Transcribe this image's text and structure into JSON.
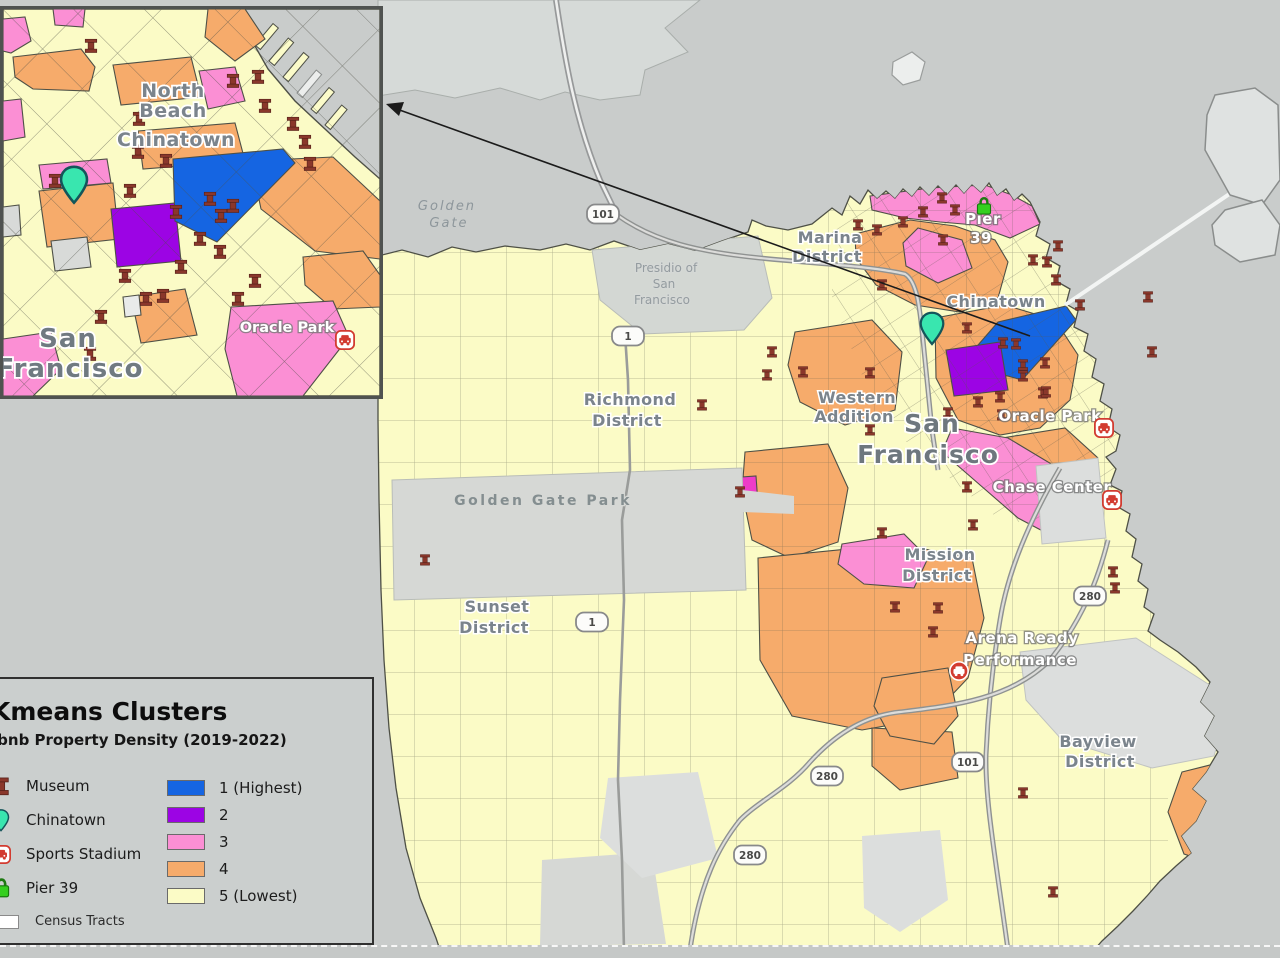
{
  "legend": {
    "title": "Kmeans Clusters",
    "subtitle": "Airbnb Property Density (2019-2022)",
    "markers": [
      {
        "label": "Museum",
        "icon": "museum-icon"
      },
      {
        "label": "Chinatown",
        "icon": "chinatown-pin-icon"
      },
      {
        "label": "Sports Stadium",
        "icon": "stadium-icon"
      },
      {
        "label": "Pier 39",
        "icon": "pier39-lock-icon"
      }
    ],
    "clusters": [
      {
        "label": "1 (Highest)",
        "color": "#1565e2"
      },
      {
        "label": "2",
        "color": "#9c04e4"
      },
      {
        "label": "3",
        "color": "#fb8fd4"
      },
      {
        "label": "4",
        "color": "#f6ab6b"
      },
      {
        "label": "5 (Lowest)",
        "color": "#fbfbc6"
      }
    ],
    "census_tracts_label": "Census Tracts"
  },
  "map": {
    "labels": [
      {
        "text": "Golden",
        "x": 447,
        "y": 210,
        "cls": "water-label"
      },
      {
        "text": "Gate",
        "x": 449,
        "y": 227,
        "cls": "water-label"
      },
      {
        "text": "Presidio of",
        "x": 666,
        "y": 272,
        "cls": "small-label"
      },
      {
        "text": "San",
        "x": 664,
        "y": 288,
        "cls": "small-label"
      },
      {
        "text": "Francisco",
        "x": 662,
        "y": 304,
        "cls": "small-label"
      },
      {
        "text": "Marina",
        "x": 830,
        "y": 243,
        "cls": "district-label"
      },
      {
        "text": "District",
        "x": 827,
        "y": 262,
        "cls": "district-label"
      },
      {
        "text": "Richmond",
        "x": 630,
        "y": 405,
        "cls": "district-label"
      },
      {
        "text": "District",
        "x": 627,
        "y": 426,
        "cls": "district-label"
      },
      {
        "text": "Western",
        "x": 857,
        "y": 403,
        "cls": "district-label"
      },
      {
        "text": "Addition",
        "x": 854,
        "y": 422,
        "cls": "district-label"
      },
      {
        "text": "San",
        "x": 932,
        "y": 432,
        "cls": "city-label"
      },
      {
        "text": "Francisco",
        "x": 928,
        "y": 463,
        "cls": "city-label"
      },
      {
        "text": "Chinatown",
        "x": 996,
        "y": 307,
        "cls": "district-label"
      },
      {
        "text": "Pier",
        "x": 983,
        "y": 224,
        "cls": "white-label"
      },
      {
        "text": "39",
        "x": 981,
        "y": 243,
        "cls": "white-label"
      },
      {
        "text": "Oracle Park",
        "x": 1050,
        "y": 421,
        "cls": "white-label"
      },
      {
        "text": "Chase Center",
        "x": 1052,
        "y": 492,
        "cls": "white-label"
      },
      {
        "text": "Mission",
        "x": 940,
        "y": 560,
        "cls": "district-label"
      },
      {
        "text": "District",
        "x": 937,
        "y": 581,
        "cls": "district-label"
      },
      {
        "text": "Arena Ready",
        "x": 1022,
        "y": 643,
        "cls": "white-label"
      },
      {
        "text": "Performance",
        "x": 1020,
        "y": 665,
        "cls": "white-label"
      },
      {
        "text": "Bayview",
        "x": 1098,
        "y": 747,
        "cls": "district-label"
      },
      {
        "text": "District",
        "x": 1100,
        "y": 767,
        "cls": "district-label"
      },
      {
        "text": "Sunset",
        "x": 497,
        "y": 612,
        "cls": "district-label"
      },
      {
        "text": "District",
        "x": 494,
        "y": 633,
        "cls": "district-label"
      },
      {
        "text": "Golden Gate Park",
        "x": 543,
        "y": 505,
        "cls": "park-label"
      }
    ],
    "shields": [
      {
        "label": "101",
        "x": 603,
        "y": 214
      },
      {
        "label": "1",
        "x": 628,
        "y": 336
      },
      {
        "label": "1",
        "x": 592,
        "y": 622
      },
      {
        "label": "280",
        "x": 1090,
        "y": 596
      },
      {
        "label": "101",
        "x": 968,
        "y": 762
      },
      {
        "label": "280",
        "x": 827,
        "y": 776
      },
      {
        "label": "280",
        "x": 750,
        "y": 855
      }
    ],
    "museum_markers": [
      [
        858,
        225
      ],
      [
        877,
        230
      ],
      [
        903,
        222
      ],
      [
        923,
        212
      ],
      [
        942,
        198
      ],
      [
        955,
        210
      ],
      [
        943,
        240
      ],
      [
        1033,
        260
      ],
      [
        1047,
        262
      ],
      [
        1056,
        280
      ],
      [
        1080,
        305
      ],
      [
        882,
        285
      ],
      [
        772,
        352
      ],
      [
        803,
        372
      ],
      [
        870,
        373
      ],
      [
        967,
        328
      ],
      [
        1003,
        343
      ],
      [
        1016,
        344
      ],
      [
        1023,
        365
      ],
      [
        1045,
        363
      ],
      [
        1000,
        397
      ],
      [
        1023,
        376
      ],
      [
        1043,
        393
      ],
      [
        1002,
        415
      ],
      [
        978,
        402
      ],
      [
        1046,
        392
      ],
      [
        948,
        413
      ],
      [
        870,
        430
      ],
      [
        967,
        487
      ],
      [
        973,
        525
      ],
      [
        882,
        533
      ],
      [
        895,
        607
      ],
      [
        938,
        608
      ],
      [
        933,
        632
      ],
      [
        1113,
        572
      ],
      [
        1115,
        588
      ],
      [
        1023,
        793
      ],
      [
        1053,
        892
      ],
      [
        425,
        560
      ],
      [
        702,
        405
      ],
      [
        740,
        492
      ],
      [
        767,
        375
      ],
      [
        1148,
        297
      ],
      [
        1152,
        352
      ],
      [
        1058,
        246
      ]
    ],
    "poi": [
      {
        "icon": "stadium-icon",
        "x": 1104,
        "y": 428
      },
      {
        "icon": "stadium-icon",
        "x": 1112,
        "y": 500
      },
      {
        "icon": "stadium-red-icon",
        "x": 959,
        "y": 671
      },
      {
        "icon": "pier39-lock-icon",
        "x": 984,
        "y": 206
      },
      {
        "icon": "chinatown-pin-icon",
        "x": 932,
        "y": 346
      }
    ]
  },
  "inset": {
    "labels": [
      {
        "text": "North",
        "x": 170,
        "y": 88,
        "cls": "inset-district"
      },
      {
        "text": "Beach",
        "x": 170,
        "y": 108,
        "cls": "inset-district"
      },
      {
        "text": "Chinatown",
        "x": 173,
        "y": 137,
        "cls": "inset-district"
      },
      {
        "text": "San",
        "x": 65,
        "y": 338,
        "cls": "inset-city"
      },
      {
        "text": "Francisco",
        "x": 67,
        "y": 368,
        "cls": "inset-city"
      },
      {
        "text": "Oracle Park",
        "x": 284,
        "y": 323,
        "cls": "inset-white"
      }
    ],
    "museum_markers": [
      [
        88,
        37
      ],
      [
        230,
        72
      ],
      [
        255,
        68
      ],
      [
        262,
        97
      ],
      [
        290,
        115
      ],
      [
        302,
        133
      ],
      [
        307,
        155
      ],
      [
        135,
        143
      ],
      [
        52,
        172
      ],
      [
        127,
        182
      ],
      [
        173,
        203
      ],
      [
        207,
        190
      ],
      [
        218,
        207
      ],
      [
        230,
        197
      ],
      [
        197,
        230
      ],
      [
        217,
        243
      ],
      [
        178,
        258
      ],
      [
        143,
        290
      ],
      [
        160,
        287
      ],
      [
        122,
        267
      ],
      [
        98,
        308
      ],
      [
        252,
        272
      ],
      [
        235,
        290
      ],
      [
        87,
        345
      ],
      [
        163,
        152
      ],
      [
        136,
        110
      ]
    ],
    "poi": [
      {
        "icon": "chinatown-pin-icon",
        "x": 71,
        "y": 196
      },
      {
        "icon": "stadium-icon",
        "x": 342,
        "y": 331
      }
    ]
  }
}
